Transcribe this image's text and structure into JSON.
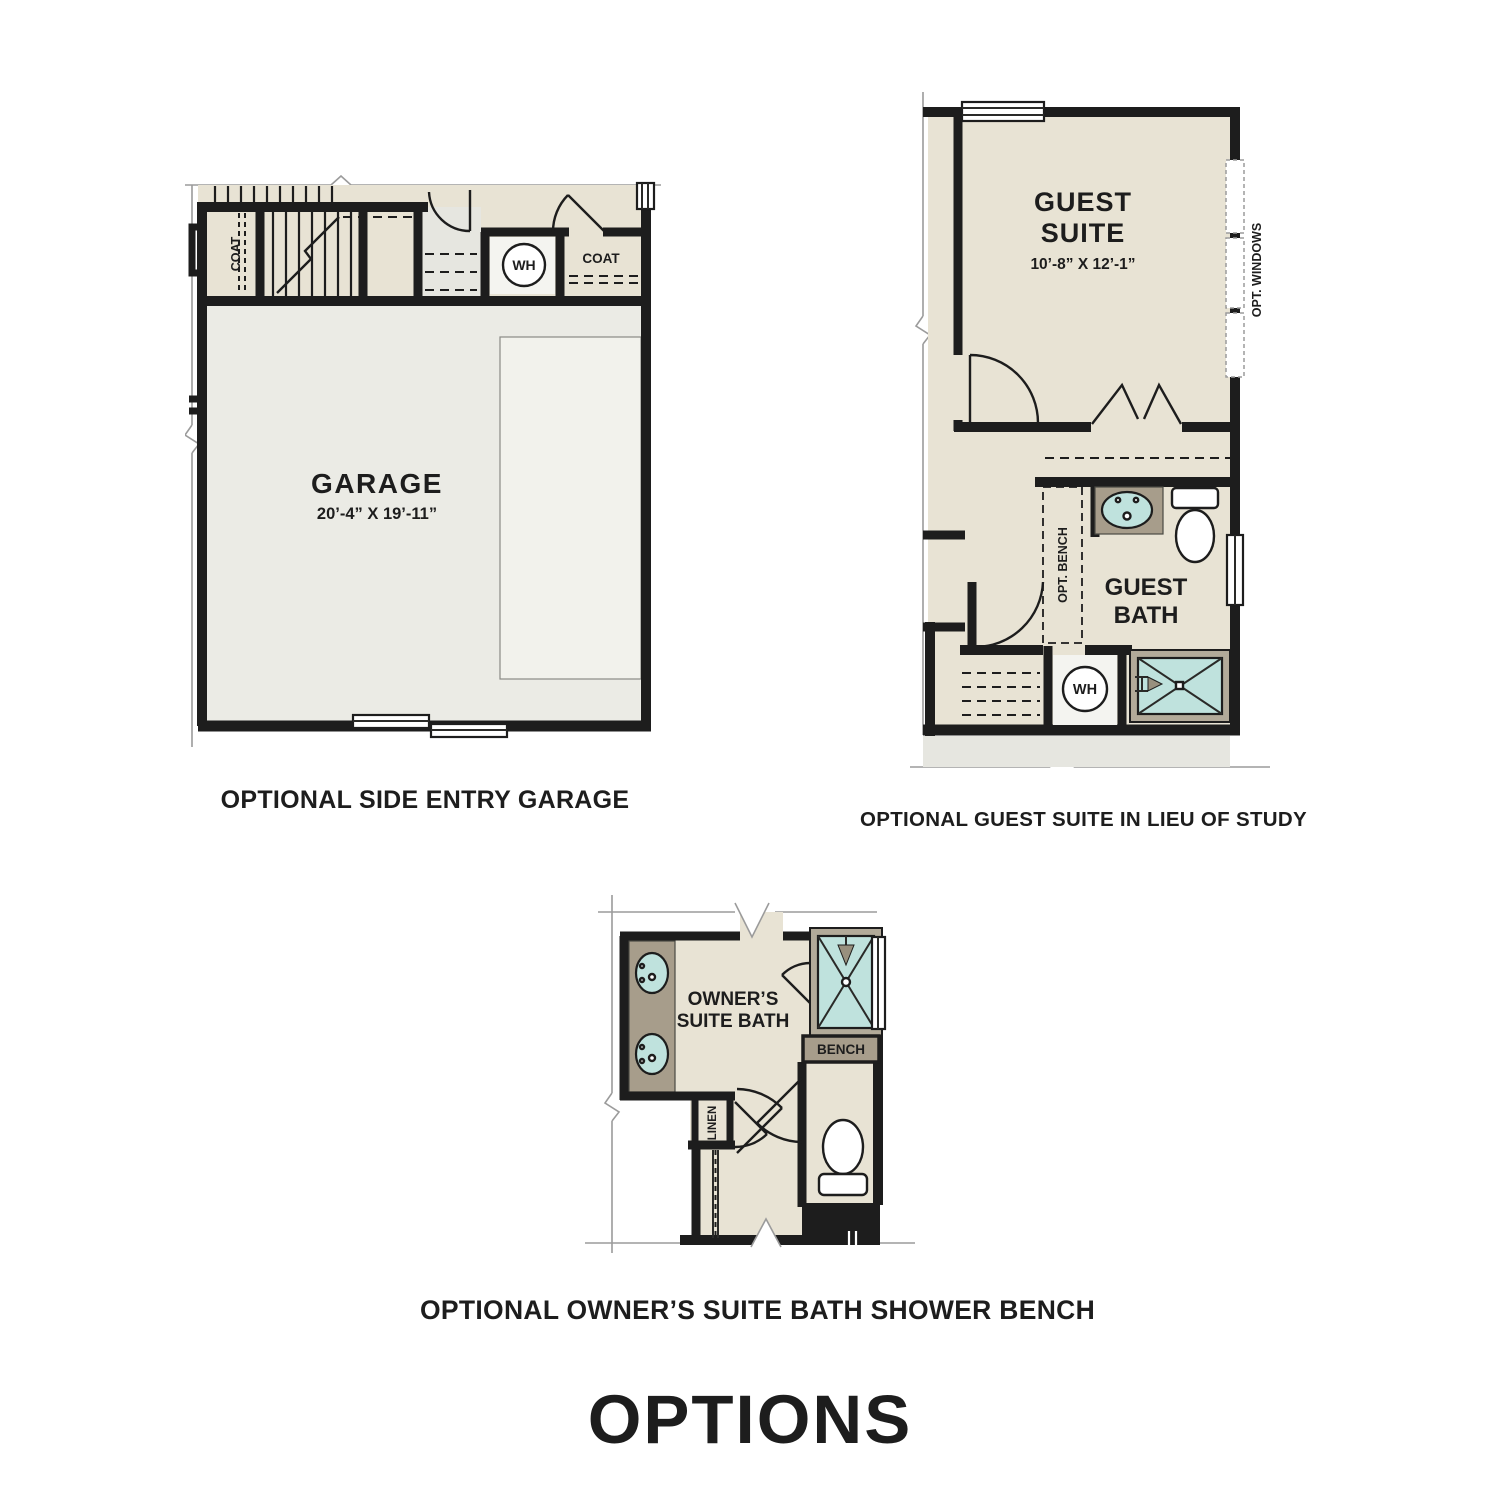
{
  "page_title": "OPTIONS",
  "colors": {
    "background": "#ffffff",
    "wall": "#1d1d1d",
    "floor_beige": "#e8e3d4",
    "floor_garage": "#ebebe5",
    "garage_pad": "#f2f2ec",
    "porch": "#e6e6e0",
    "counter_brown": "#a79d8b",
    "fixture_teal": "#bfe2dd",
    "shower_frame_tan": "#b2aa99",
    "line_gray": "#9b9b9b",
    "text": "#1d1d1d"
  },
  "plans": {
    "garage": {
      "caption": "OPTIONAL SIDE ENTRY GARAGE",
      "room_label": "GARAGE",
      "room_dims": "20’-4” X 19’-11”",
      "coat_left_label": "COAT",
      "coat_right_label": "COAT",
      "water_heater_label": "WH"
    },
    "guest_suite": {
      "caption": "OPTIONAL GUEST SUITE IN LIEU OF STUDY",
      "room_label_line1": "GUEST",
      "room_label_line2": "SUITE",
      "room_dims": "10’-8” X 12’-1”",
      "bath_label_line1": "GUEST",
      "bath_label_line2": "BATH",
      "opt_windows_label": "OPT. WINDOWS",
      "opt_bench_label": "OPT. BENCH",
      "water_heater_label": "WH"
    },
    "owners_bath": {
      "caption": "OPTIONAL OWNER’S SUITE BATH SHOWER BENCH",
      "room_label_line1": "OWNER’S",
      "room_label_line2": "SUITE BATH",
      "bench_label": "BENCH",
      "linen_label": "LINEN"
    }
  }
}
